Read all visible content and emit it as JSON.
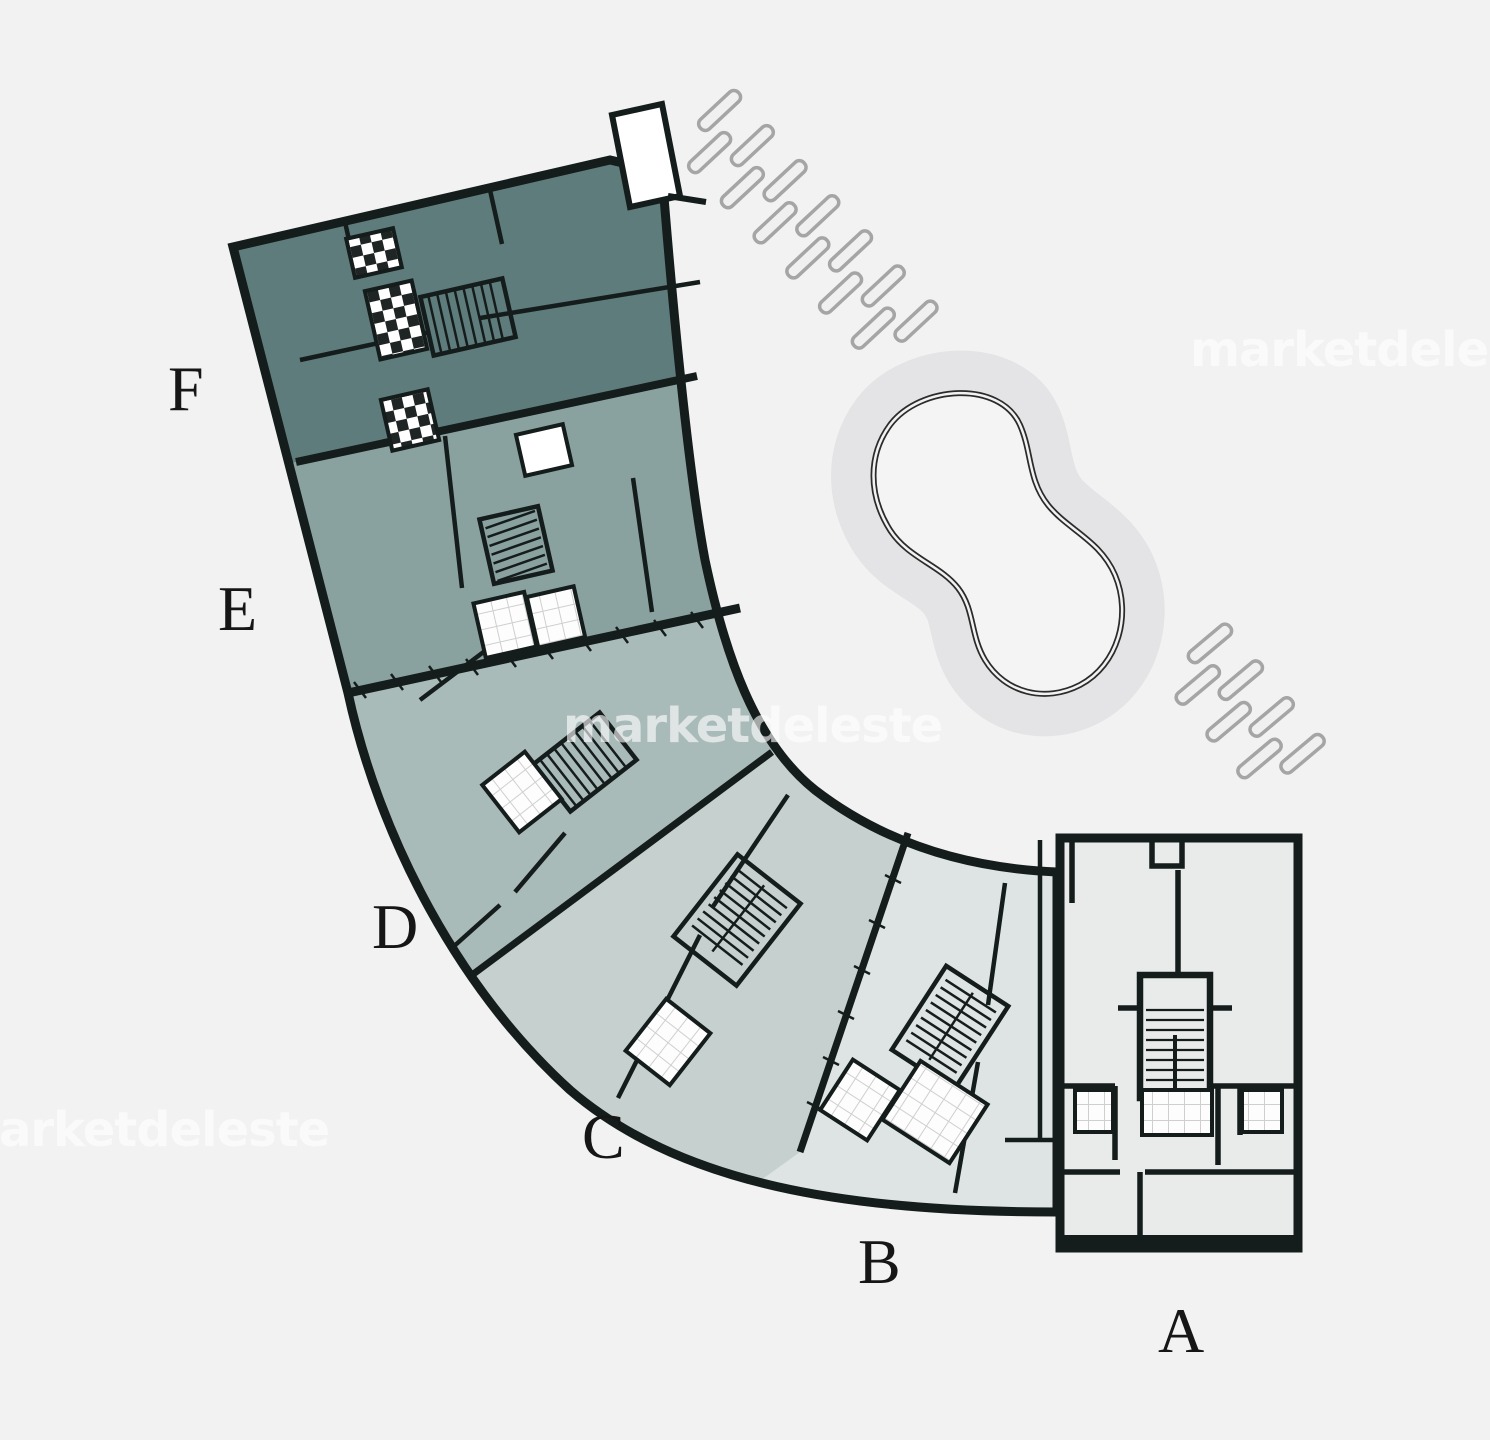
{
  "canvas": {
    "background": "#f2f2f2",
    "wall_color": "#151c1c"
  },
  "watermark": {
    "text": "marketdeleste"
  },
  "sections": [
    {
      "label": "A",
      "color": "#e8ebea"
    },
    {
      "label": "B",
      "color": "#dde4e3"
    },
    {
      "label": "C",
      "color": "#c6d1cf"
    },
    {
      "label": "D",
      "color": "#a9bbb8"
    },
    {
      "label": "E",
      "color": "#8aa29f"
    },
    {
      "label": "F",
      "color": "#5e7c7b"
    }
  ],
  "pool": {
    "deck_color": "#e4e4e6",
    "water_color": "#f4f4f5"
  }
}
